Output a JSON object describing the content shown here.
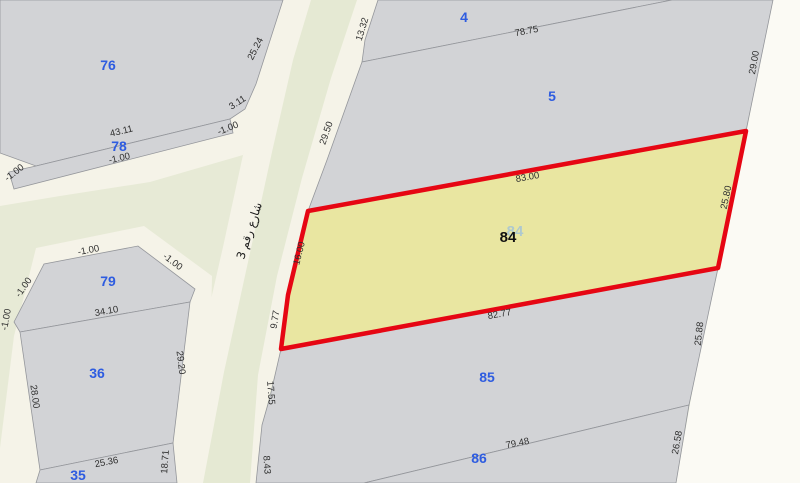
{
  "app": {
    "type": "cadastral-parcel-map"
  },
  "colors": {
    "background": "#e7ead6",
    "street": "#f5f3e8",
    "street_light": "#fbfaf4",
    "street_median": "#e5e9d3",
    "parcel_fill": "#d2d3d6",
    "parcel_stroke": "#94969b",
    "highlight_fill": "#e9e6a1",
    "highlight_stroke": "#e60613",
    "parcel_number": "#2e5ce0",
    "dimension_text": "#2f2f2f",
    "selected_label": "#111111",
    "selected_ghost": "#a9c6d3"
  },
  "street_label": {
    "text": "شارع رقم 3"
  },
  "selected_parcel": {
    "label": "84",
    "ghost_label": "84"
  },
  "parcel_labels": [
    {
      "id": "76"
    },
    {
      "id": "78"
    },
    {
      "id": "79"
    },
    {
      "id": "36"
    },
    {
      "id": "35"
    },
    {
      "id": "4"
    },
    {
      "id": "5"
    },
    {
      "id": "85"
    },
    {
      "id": "86"
    }
  ],
  "dimension_labels": [
    {
      "text": "57"
    },
    {
      "text": "-1.00"
    },
    {
      "text": "43.11"
    },
    {
      "text": "-1.00"
    },
    {
      "text": "25.24"
    },
    {
      "text": "3.11"
    },
    {
      "text": "-1.00"
    },
    {
      "text": "13.32"
    },
    {
      "text": "78.75"
    },
    {
      "text": "29.00"
    },
    {
      "text": "29.50"
    },
    {
      "text": "16.00"
    },
    {
      "text": "83.00"
    },
    {
      "text": "25.80"
    },
    {
      "text": "9.77"
    },
    {
      "text": "82.77"
    },
    {
      "text": "25.88"
    },
    {
      "text": "-1.00"
    },
    {
      "text": "-1.00"
    },
    {
      "text": "-1.00"
    },
    {
      "text": "-1.00"
    },
    {
      "text": "34.10"
    },
    {
      "text": "29.20"
    },
    {
      "text": "28.00"
    },
    {
      "text": "25.36"
    },
    {
      "text": "18.71"
    },
    {
      "text": "17.55"
    },
    {
      "text": "8.43"
    },
    {
      "text": "26.58"
    },
    {
      "text": "79.48"
    }
  ]
}
